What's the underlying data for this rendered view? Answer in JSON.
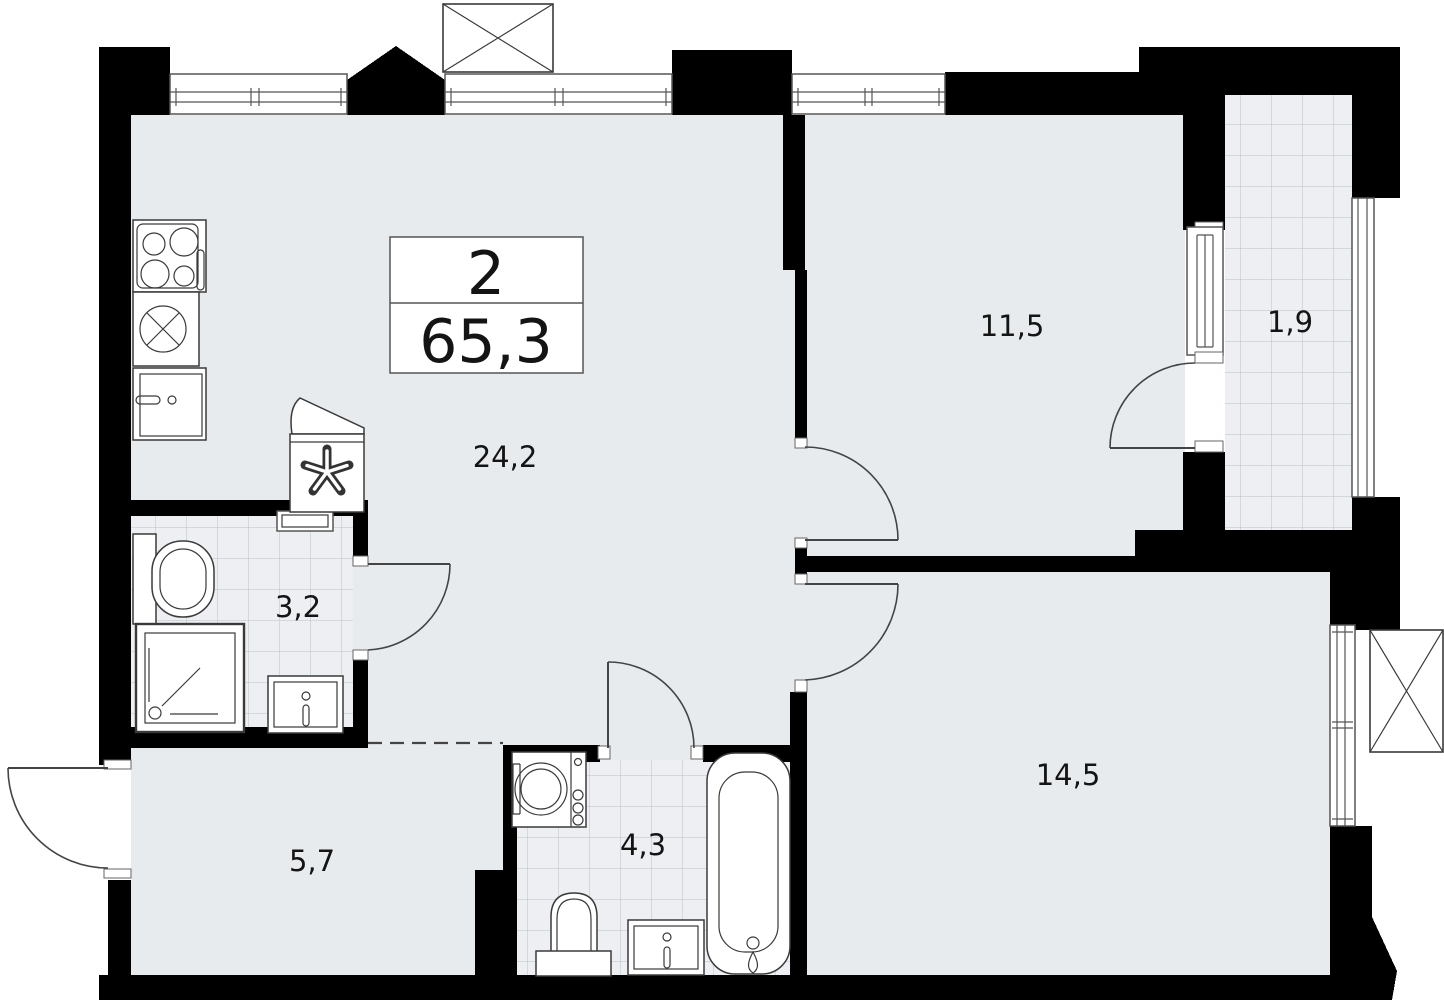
{
  "plan": {
    "summary": {
      "rooms": "2",
      "area": "65,3"
    },
    "rooms": [
      {
        "id": "living-kitchen",
        "area": "24,2"
      },
      {
        "id": "bedroom-1",
        "area": "11,5"
      },
      {
        "id": "balcony",
        "area": "1,9"
      },
      {
        "id": "bathroom-1",
        "area": "3,2"
      },
      {
        "id": "bedroom-2",
        "area": "14,5"
      },
      {
        "id": "hallway",
        "area": "5,7"
      },
      {
        "id": "bathroom-2",
        "area": "4,3"
      }
    ],
    "colors": {
      "floor": "#e8ebee",
      "tile_line": "#b9c0c7",
      "wall": "#000000",
      "line": "#3a3a3a"
    }
  }
}
